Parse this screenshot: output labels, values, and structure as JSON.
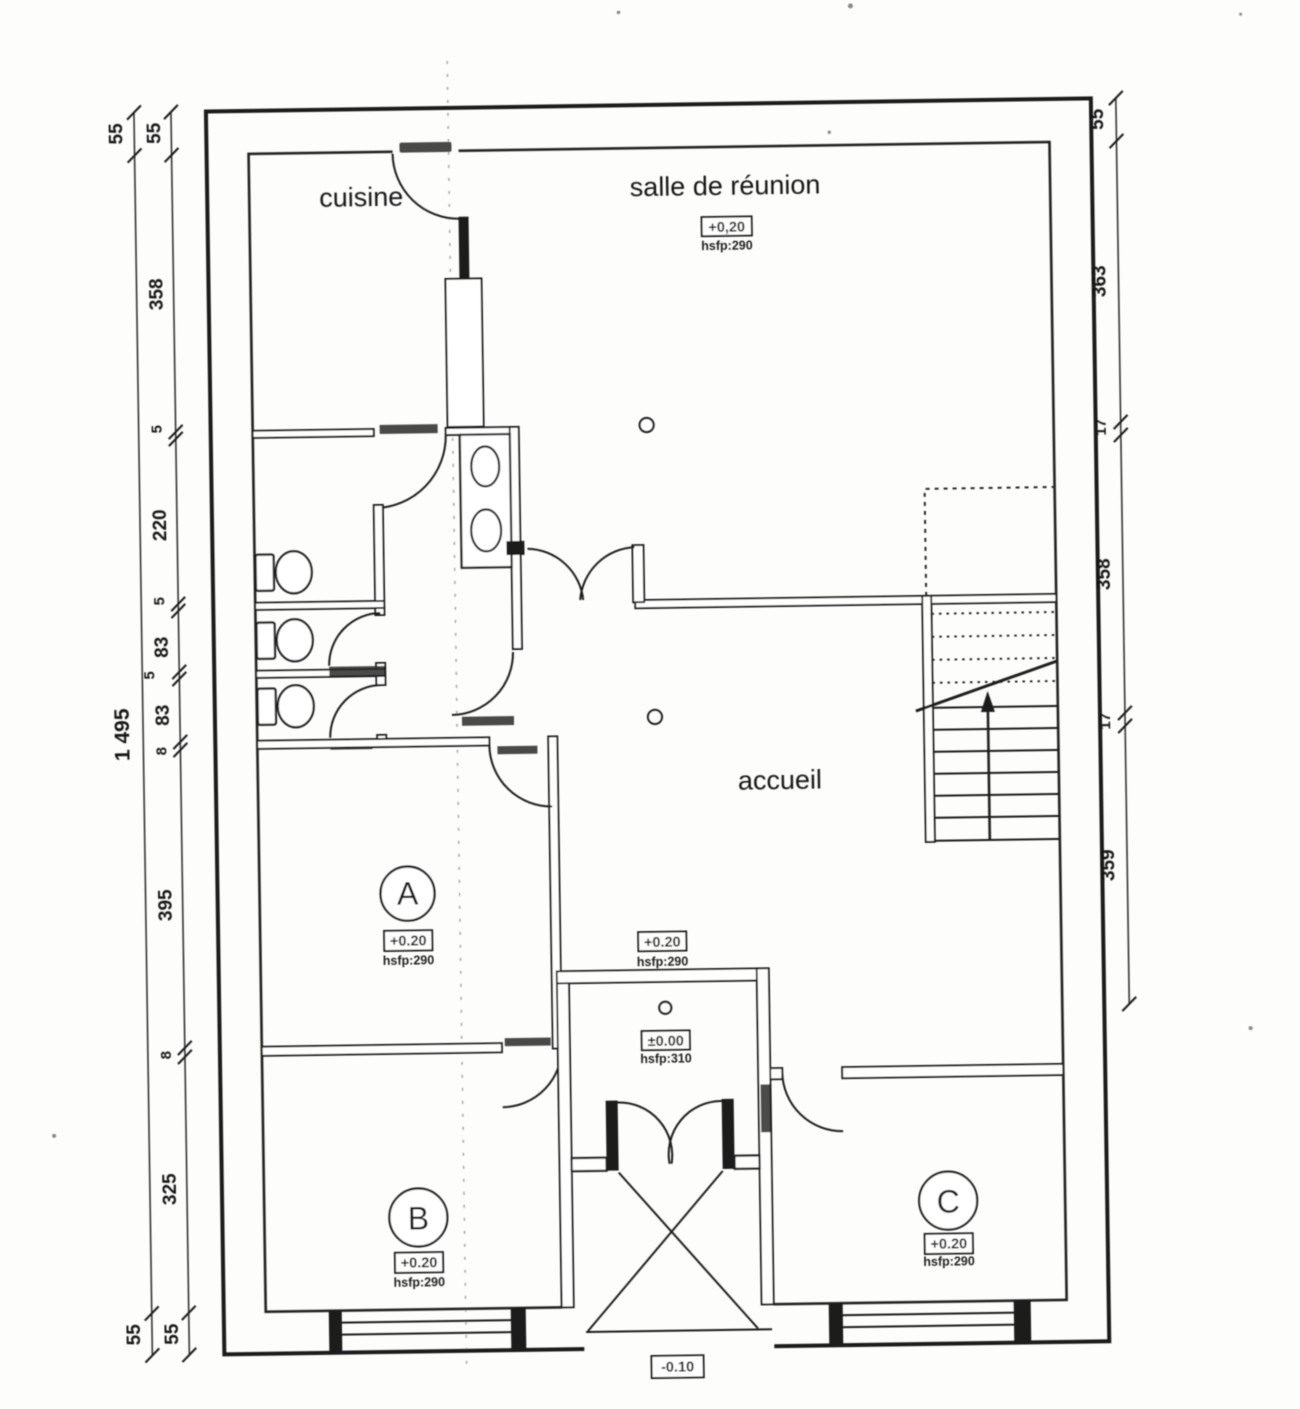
{
  "plan": {
    "rooms": {
      "cuisine": {
        "label": "cuisine"
      },
      "salle": {
        "label": "salle de réunion",
        "level": "+0,20",
        "ceiling": "hsfp:290"
      },
      "accueil": {
        "label": "accueil"
      },
      "hall": {
        "level": "+0.20",
        "ceiling": "hsfp:290"
      },
      "room_a": {
        "label": "A",
        "level": "+0.20",
        "ceiling": "hsfp:290"
      },
      "room_b": {
        "label": "B",
        "level": "+0.20",
        "ceiling": "hsfp:290"
      },
      "room_c": {
        "label": "C",
        "level": "+0.20",
        "ceiling": "hsfp:290"
      },
      "vestibule": {
        "level": "±0.00",
        "ceiling": "hsfp:310"
      },
      "exterior": {
        "level": "-0.10"
      }
    },
    "dimensions": {
      "left_outer": [
        "55",
        "1 495",
        "55"
      ],
      "left_inner": [
        "55",
        "358",
        "5",
        "220",
        "5",
        "83",
        "5",
        "83",
        "8",
        "395",
        "8",
        "325",
        "55"
      ],
      "right": [
        "55",
        "363",
        "17",
        "358",
        "17",
        "359"
      ]
    }
  }
}
